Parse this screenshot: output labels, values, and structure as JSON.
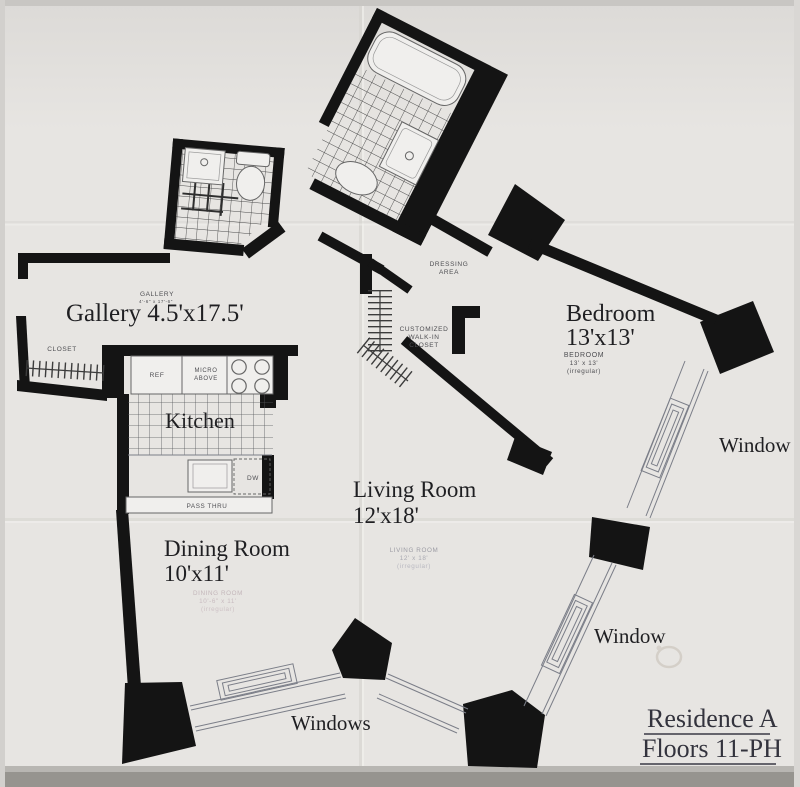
{
  "document": {
    "type": "floor-plan",
    "title": {
      "line1": "Residence A",
      "line2": "Floors 11-PH"
    }
  },
  "rooms": {
    "gallery": {
      "handwritten": "Gallery 4.5'x17.5'",
      "printed_name": "GALLERY",
      "printed_dims": "4'-6\" x 17'-6\""
    },
    "closet": {
      "printed_name": "CLOSET"
    },
    "kitchen": {
      "handwritten": "Kitchen",
      "fixtures": {
        "refrigerator": "REF",
        "microwave_line1": "MICRO",
        "microwave_line2": "ABOVE",
        "dishwasher": "DW",
        "pass_thru": "PASS THRU"
      }
    },
    "dining_room": {
      "handwritten_line1": "Dining Room",
      "handwritten_line2": "10'x11'",
      "printed_name": "DINING ROOM",
      "printed_dims": "10'-6\" x 11'",
      "printed_note": "(irregular)"
    },
    "living_room": {
      "handwritten_line1": "Living Room",
      "handwritten_line2": "12'x18'",
      "printed_name": "LIVING ROOM",
      "printed_dims": "12' x 18'",
      "printed_note": "(irregular)"
    },
    "bedroom": {
      "handwritten_line1": "Bedroom",
      "handwritten_line2": "13'x13'",
      "printed_name": "BEDROOM",
      "printed_dims": "13' x 13'",
      "printed_note": "(irregular)"
    },
    "dressing_area": {
      "printed_line1": "DRESSING",
      "printed_line2": "AREA"
    },
    "walk_in_closet": {
      "printed_line1": "CUSTOMIZED",
      "printed_line2": "WALK-IN",
      "printed_line3": "CLOSET"
    }
  },
  "windows": {
    "upper_right_label": "Window",
    "lower_right_label": "Window",
    "bottom_label": "Windows"
  },
  "colors": {
    "paper": "#e7e5e2",
    "walls": "#141414",
    "thin_lines": "#7b7e88",
    "handwriting": "#1f1f22",
    "printed_text": "#4e4e52",
    "faint_text": "#c3b6ba",
    "title_text": "#33333d"
  }
}
